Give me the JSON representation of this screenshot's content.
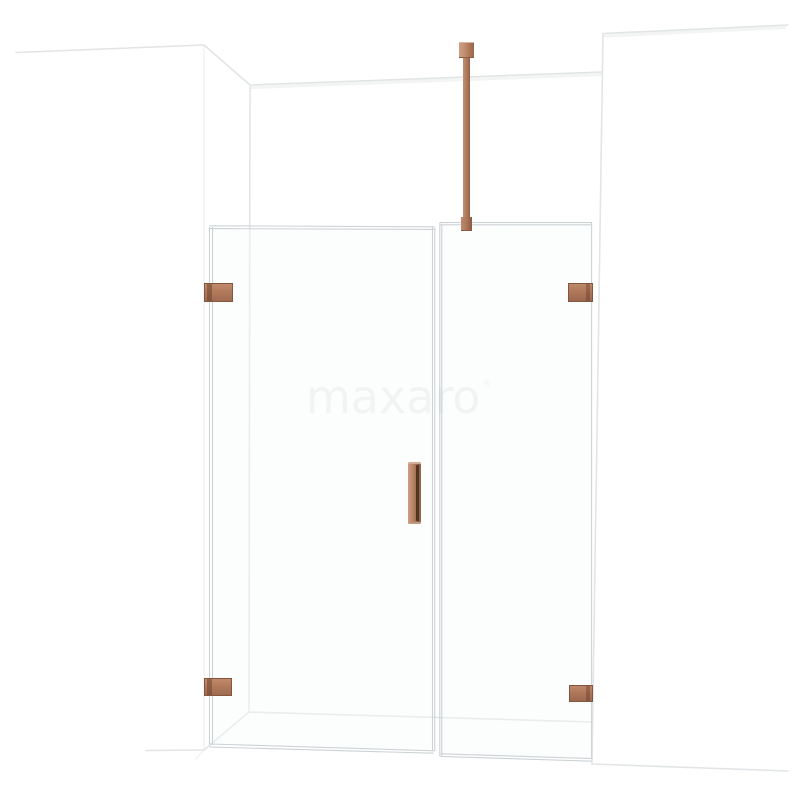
{
  "watermark": {
    "text": "maxaro",
    "registered_mark": "®",
    "color": "#eff1f1"
  },
  "colors": {
    "copper": "#b1795b",
    "copper_light": "#c59276",
    "copper_dark": "#8a5a43",
    "copper_deep": "#4e3526",
    "glass_edge_line": "#ccd2d5",
    "wall_line": "#e2e5e7",
    "floor_shadow_line": "#c7c7c7",
    "background": "#ffffff",
    "watermark_color": "#eff1f1"
  }
}
